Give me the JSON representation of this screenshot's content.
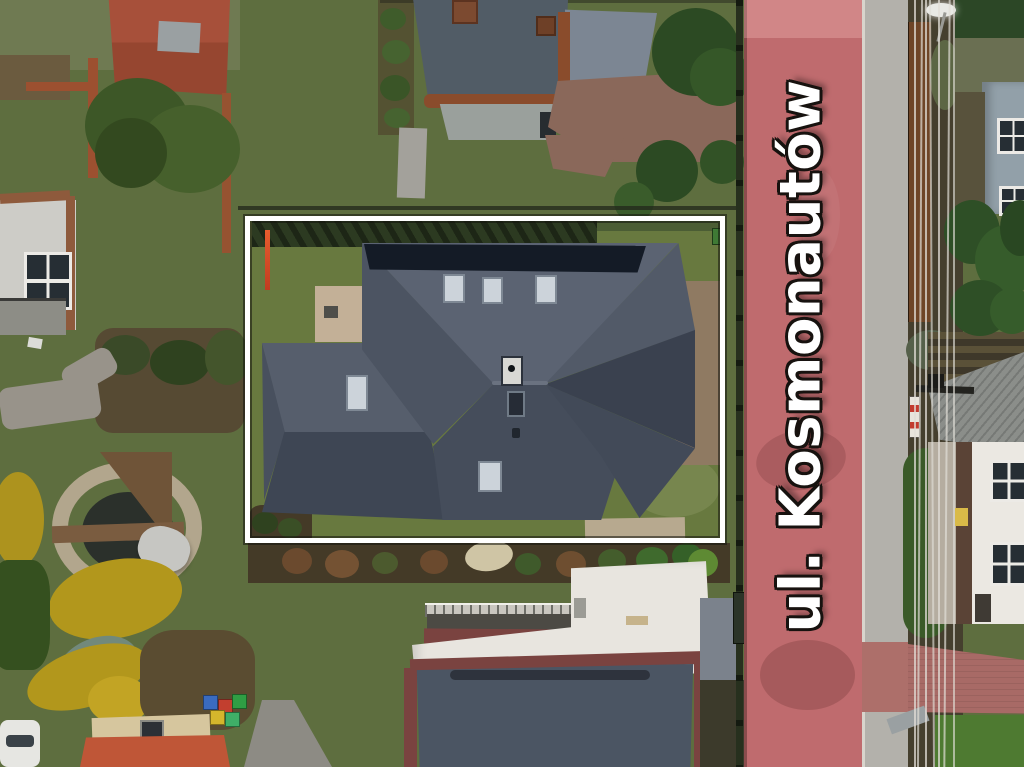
{
  "annotation": {
    "street_label": "ul. Kosmonautów",
    "type": "aerial-property-photo",
    "boundary_shape": "rectangle"
  },
  "objects": [
    "property-boundary",
    "main-house-hip-roof",
    "solar-panel-array",
    "roof-skylights",
    "chimney",
    "front-lawn",
    "garden-patio",
    "red-survey-pole",
    "street-road",
    "street-name-label",
    "sidewalk",
    "power-lines",
    "street-lamp",
    "utility-pole",
    "neighbor-house-north",
    "brick-patio-north",
    "neighbor-flat-roof-house-south",
    "roof-terrace-railing",
    "garden-pond",
    "wooden-deck",
    "yellow-conifer-bushes",
    "beehives",
    "red-tile-roof-southwest",
    "white-car",
    "left-balcony-building",
    "garage-red-roof-northwest",
    "big-tree",
    "rust-wall",
    "board-fence",
    "hedge-row",
    "shrub-bed",
    "gray-oblique-roof-east",
    "white-house-east",
    "blue-gray-building-east",
    "conifer-group-east",
    "red-paved-driveway"
  ],
  "palette": {
    "lawn": "#5e6e3f",
    "lawnIn": "#68793f",
    "lawnDry": "#6f7a52",
    "road": "#bf6b6e",
    "roadTop": "#cb7a7b",
    "walk": "#b3b1ab",
    "curb": "#d8d4cc",
    "rust": "#9c5030",
    "maroon": "#7a4340",
    "boundary": "#ffffff",
    "labelFill": "#ffffff",
    "labelOutline": "#17120f",
    "roofN": "#5b6372",
    "roofMid": "#4c5462",
    "roofS": "#454d5b",
    "roofDark": "#3a414f",
    "wingN": "#565e6c",
    "wingS": "#3e4654",
    "solar": "#141b26",
    "brick": "#8a685a",
    "patio": "#c3b097",
    "soil": "#453f2e",
    "bed": "#443a27",
    "hedge": "#2c3a21",
    "bushDark": "#2c4a23",
    "ybush": "#b2971c",
    "redroofTL": "#a7503a",
    "redroofBL": "#bf5637",
    "whiteRoof": "#e8e5df",
    "darkRoof": "#4b5563",
    "pond": "#2b302b",
    "pebble": "#b2a68d",
    "wire": "#e0ddd5",
    "fence": "#1f2618",
    "brownFence": "#6e4527",
    "grayRoof": "#8b8e8a",
    "houseWhite": "#ebe8e2",
    "bldgBlue": "#92a0a9",
    "hedgeGreen": "#3a5a28",
    "brightHedge": "#4e7a31",
    "gravel": "#b5ada0",
    "deck": "#7a5c40",
    "neighborRoofL": "#515c66",
    "neighborRoofR": "#7c8693"
  }
}
